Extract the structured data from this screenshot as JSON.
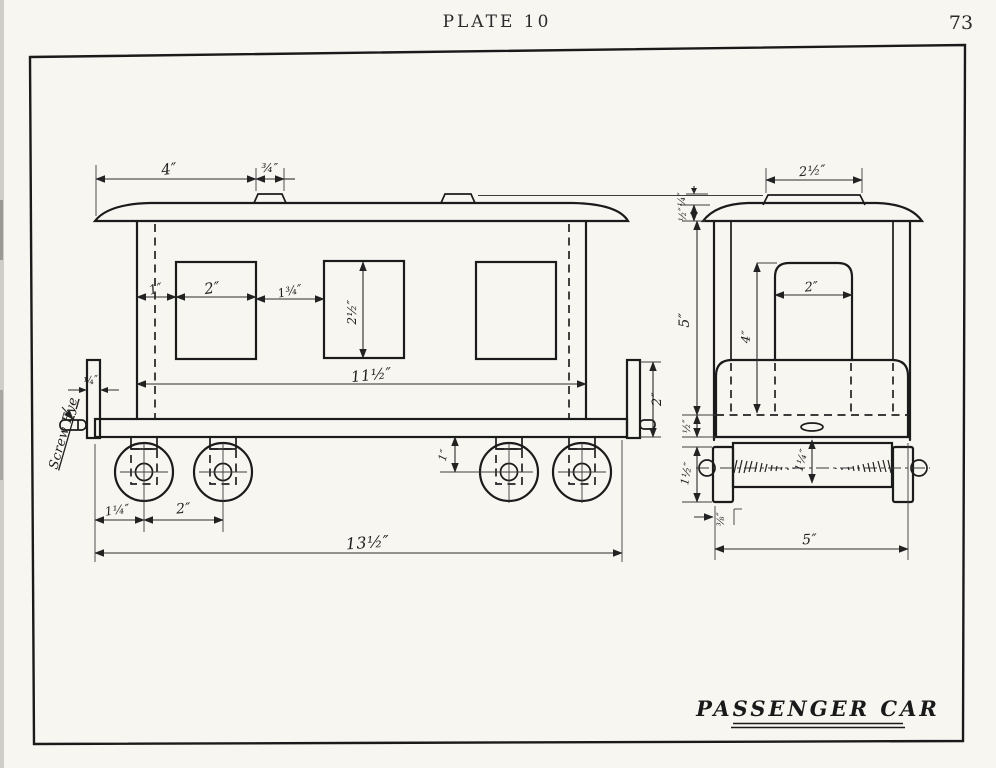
{
  "page": {
    "plate_label": "PLATE 10",
    "page_number": "73",
    "paper_color": "#f7f6f1",
    "ink_color": "#1b1b1b"
  },
  "title_block": {
    "title": "PASSENGER CAR"
  },
  "side_view": {
    "labels": {
      "screw_eye": "Screw Eye"
    },
    "dims": {
      "roof_overhang": "4″",
      "vent_width": "¾″",
      "post_to_window": "1″",
      "window_width": "2″",
      "window_gap": "1¾″",
      "window_height": "2½″",
      "body_length": "11½″",
      "post_thickness": "¼″",
      "platform_post_height": "2″",
      "axle_drop": "1″",
      "end_to_first_axle": "1¼″",
      "axle_spacing": "2″",
      "overall_length": "13½″"
    }
  },
  "end_view": {
    "dims": {
      "clerestory_width": "2½″",
      "clerestory_height": "¼″",
      "roof_thickness": "½″",
      "body_height": "5″",
      "window_height": "4″",
      "window_width": "2″",
      "floor_thickness": "½″",
      "wheel_diameter": "1½″",
      "axle_assembly_height": "1¼″",
      "wheel_thickness": "⅜″",
      "overall_width": "5″"
    }
  }
}
